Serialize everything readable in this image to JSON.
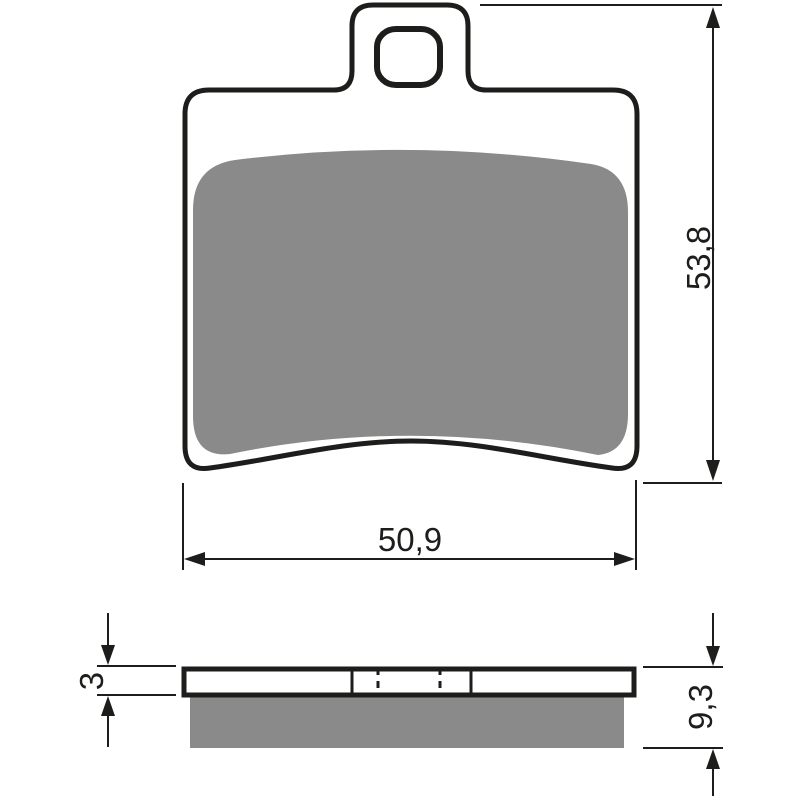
{
  "drawing": {
    "views": {
      "top": {
        "width_label": "50,9",
        "height_label": "53,8"
      },
      "side": {
        "backplate_thickness_label": "3",
        "total_thickness_label": "9,3"
      }
    },
    "colors": {
      "line": "#1d1d1b",
      "friction_material": "#8a8a8a",
      "background": "#ffffff"
    }
  }
}
